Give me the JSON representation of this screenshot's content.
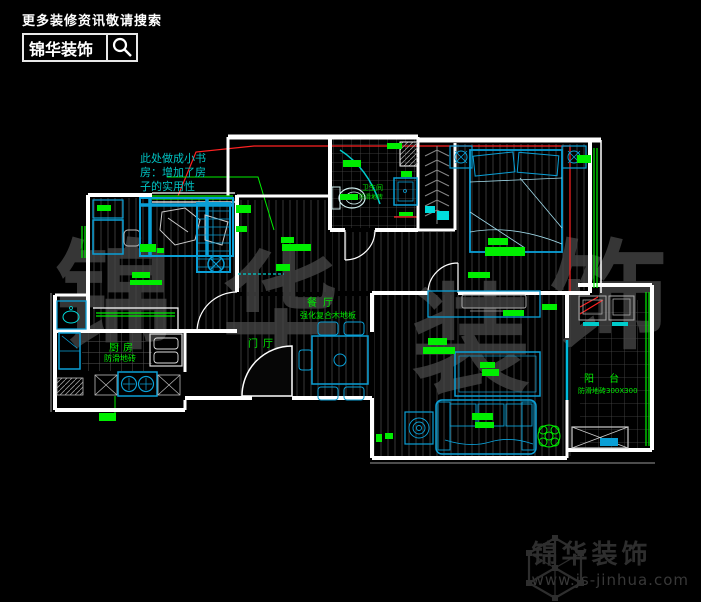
{
  "header": {
    "tagline": "更多装修资讯敬请搜索",
    "brand": "锦华装饰"
  },
  "footer": {
    "brand": "锦华装饰",
    "url": "www.js-jinhua.com"
  },
  "watermark": {
    "chars": [
      "锦",
      "华",
      "装",
      "饰"
    ]
  },
  "plan": {
    "annotation": {
      "line1": "此处做成小书",
      "line2": "房：增加了房",
      "line3": "子的实用性"
    },
    "rooms": {
      "entry": "门厅",
      "dining": "餐厅",
      "dining_floor": "强化复合木地板",
      "kitchen": "厨房",
      "kitchen_floor": "防滑地砖",
      "bath": "卫生间",
      "bath_floor": "防滑地砖",
      "balcony": "阳 台",
      "balcony_floor": "防滑地砖300X300"
    },
    "colors": {
      "wall": "#ffffff",
      "furniture_blue": "#0a9fd6",
      "accent_cyan": "#00dddd",
      "label_green": "#00ee00",
      "annotation_cyan": "#00c3c3",
      "leader_red": "#ff2222",
      "watermark_gray": "#444444"
    }
  }
}
